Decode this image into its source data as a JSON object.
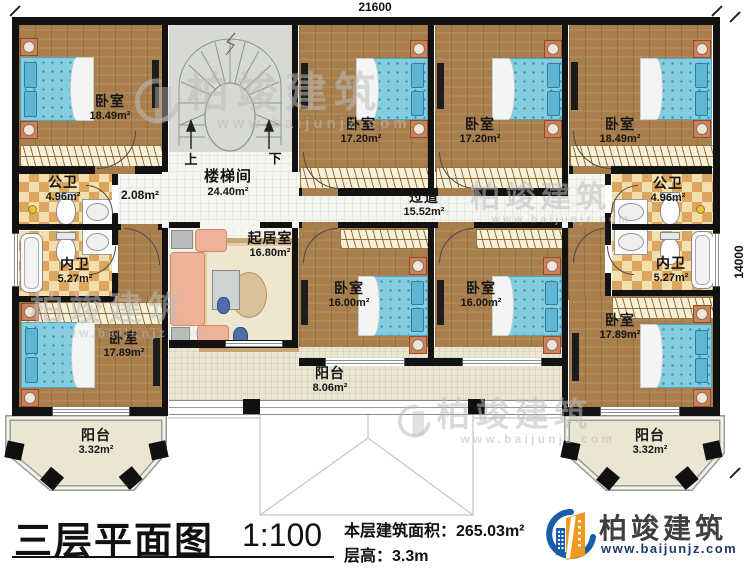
{
  "dimensions": {
    "width": "21600",
    "height": "14000"
  },
  "stairwell": {
    "name": "楼梯间",
    "area": "24.40m²",
    "up": "上",
    "down": "下"
  },
  "hall_area": "2.08m²",
  "rooms": [
    {
      "name": "卧室",
      "area": "18.49m²"
    },
    {
      "name": "卧室",
      "area": "17.20m²"
    },
    {
      "name": "卧室",
      "area": "17.20m²"
    },
    {
      "name": "卧室",
      "area": "18.49m²"
    },
    {
      "name": "公卫",
      "area": "4.96m²"
    },
    {
      "name": "内卫",
      "area": "5.27m²"
    },
    {
      "name": "过道",
      "area": "15.52m²"
    },
    {
      "name": "公卫",
      "area": "4.96m²"
    },
    {
      "name": "内卫",
      "area": "5.27m²"
    },
    {
      "name": "起居室",
      "area": "16.80m²"
    },
    {
      "name": "卧室",
      "area": "16.00m²"
    },
    {
      "name": "卧室",
      "area": "16.00m²"
    },
    {
      "name": "卧室",
      "area": "17.89m²"
    },
    {
      "name": "卧室",
      "area": "17.89m²"
    },
    {
      "name": "阳台",
      "area": "8.06m²"
    },
    {
      "name": "阳台",
      "area": "3.32m²"
    },
    {
      "name": "阳台",
      "area": "3.32m²"
    }
  ],
  "title_block": {
    "title": "三层平面图",
    "scale": "1:100",
    "floor_area": "本层建筑面积：265.03m²",
    "floor_height": "层高：3.3m"
  },
  "brand": {
    "name": "柏竣建筑",
    "url": "www.baijunjz.com"
  },
  "watermark": {
    "name": "柏竣建筑",
    "url": "www.baijunjz.com"
  }
}
